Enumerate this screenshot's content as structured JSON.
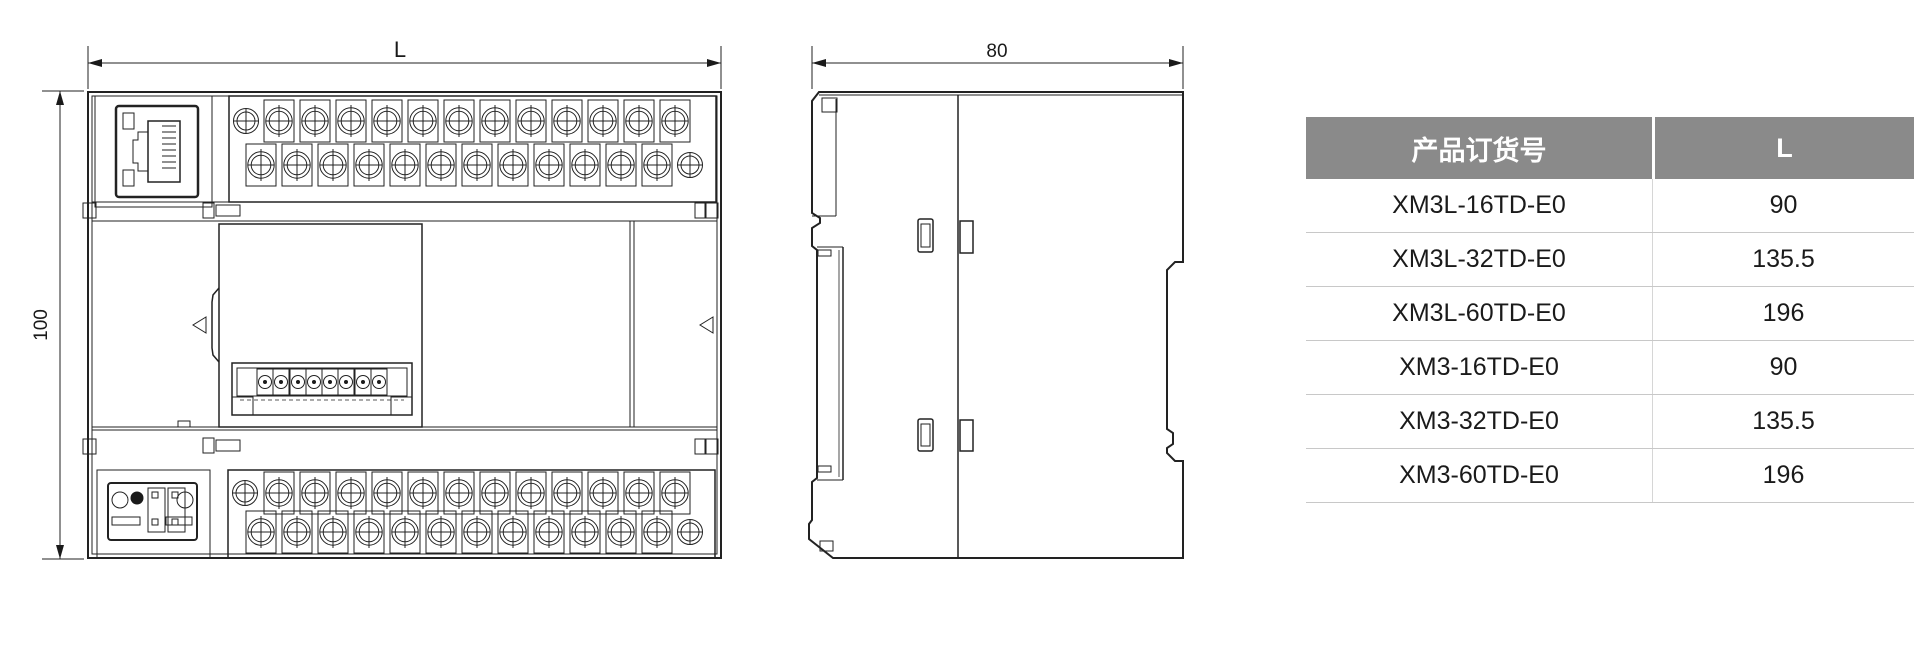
{
  "page": {
    "background": "#ffffff"
  },
  "drawing": {
    "front_view": {
      "width_label": "L",
      "height_label": "100"
    },
    "side_view": {
      "width_label": "80"
    }
  },
  "table": {
    "headers": {
      "product": "产品订货号",
      "length": "L"
    },
    "rows": [
      {
        "product": "XM3L-16TD-E0",
        "length": "90"
      },
      {
        "product": "XM3L-32TD-E0",
        "length": "135.5"
      },
      {
        "product": "XM3L-60TD-E0",
        "length": "196"
      },
      {
        "product": "XM3-16TD-E0",
        "length": "90"
      },
      {
        "product": "XM3-32TD-E0",
        "length": "135.5"
      },
      {
        "product": "XM3-60TD-E0",
        "length": "196"
      }
    ],
    "style": {
      "header_bg": "#8a8a8a",
      "header_text": "#ffffff",
      "row_line": "#c8c8c8",
      "body_text": "#1a1a1a"
    }
  }
}
